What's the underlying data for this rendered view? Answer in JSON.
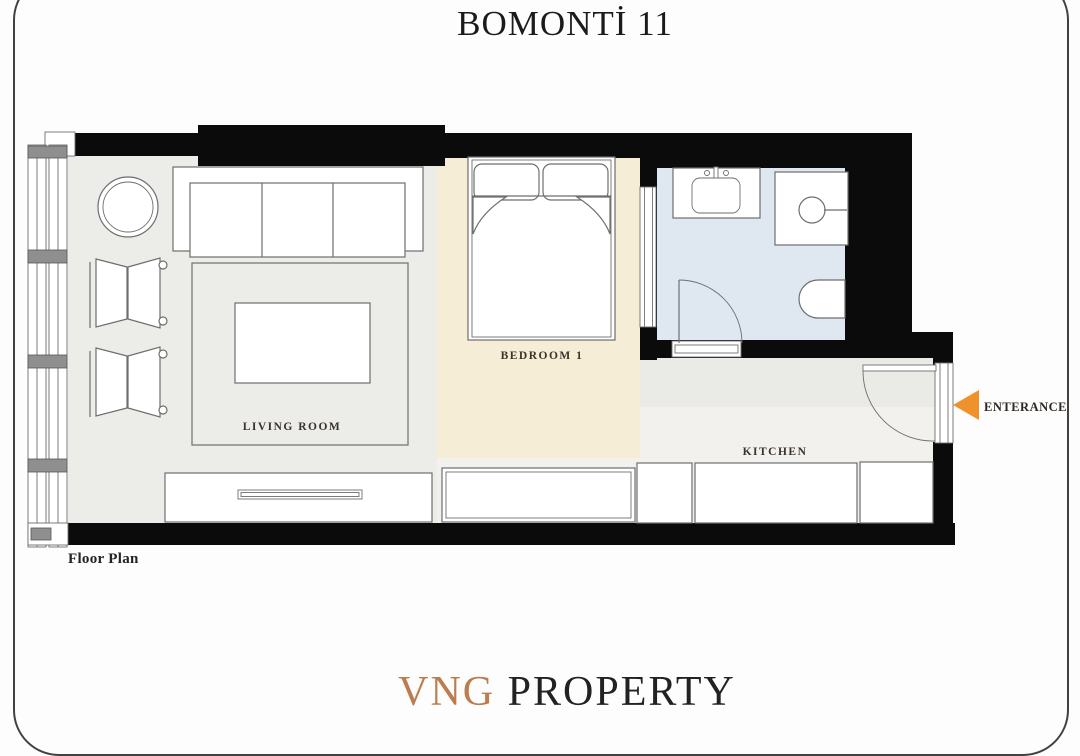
{
  "title": "BOMONTİ 11",
  "plan": {
    "caption": "Floor Plan",
    "wall_color": "#0b0b0b",
    "rooms": {
      "living_room": {
        "label": "LIVING ROOM",
        "floor_color": "#ECECE9"
      },
      "bedroom": {
        "label": "BEDROOM 1",
        "floor_color": "#F6EDD7"
      },
      "kitchen": {
        "label": "KITCHEN",
        "floor_color": "#F2F1ED"
      },
      "hallway": {
        "floor_color": "#EAEAE6"
      },
      "bathroom": {
        "floor_color": "#DFE8F1"
      }
    },
    "entrance": {
      "label": "ENTERANCE",
      "arrow_color": "#F0922B"
    },
    "furniture": [
      "window-wall",
      "round-table",
      "sofa",
      "armchair",
      "armchair",
      "rug",
      "coffee-table",
      "tv-unit",
      "double-bed",
      "wardrobe",
      "kitchen-counters",
      "bathroom-vanity",
      "shower",
      "toilet",
      "bathroom-door",
      "bedroom-bathroom-door",
      "entrance-door"
    ]
  },
  "brand": {
    "name_accent": "VNG",
    "name_rest": "PROPERTY",
    "accent_color": "#bd7c4d",
    "rest_color": "#222222"
  }
}
